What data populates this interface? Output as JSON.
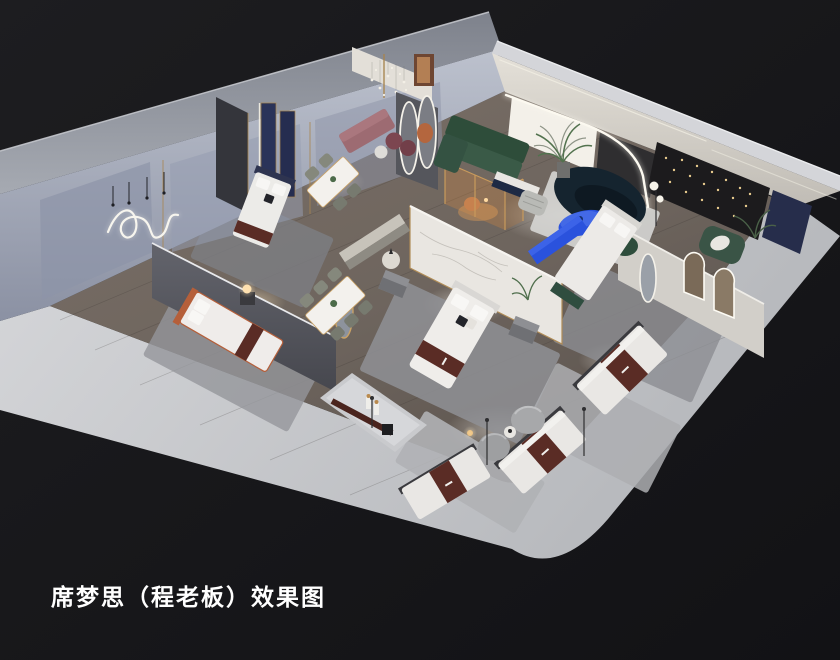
{
  "scene": {
    "type": "3d-interior-showroom-render",
    "caption": "席梦思（程老板）效果图"
  },
  "colors": {
    "background": "#17171a",
    "platform": "#cdced2",
    "exterior_wall": "#91959f",
    "interior_wall_blue_grey": "#9aa1b2",
    "ne_wall_warm_white": "#ddd9d1",
    "wood_floor": "#6e655e",
    "rug_grey": "#a2a3a7",
    "bedding_white": "#edebe8",
    "mattress_runner_brown": "#5a2c25",
    "accent_cobalt": "#2a52dd",
    "sofa_green": "#2e4d3a",
    "sofa_teal_navy": "#15242f",
    "gold_trim": "#b08c57",
    "navy_panel": "#2a3359",
    "led_white": "#fbf8ef",
    "lamp_glow": "#ffd9a0",
    "caption_text": "#ffffff"
  }
}
